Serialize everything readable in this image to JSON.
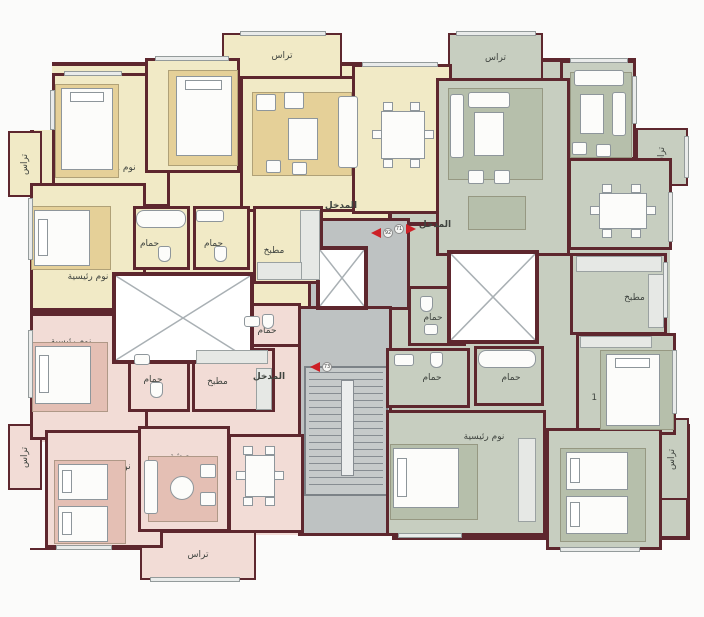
{
  "colors": {
    "wall": "#5e272e",
    "white": "#fbfbfa",
    "label": "#3f443f",
    "red": "#cd2026",
    "u1": "#f1eac6",
    "u2": "#c7cec0",
    "u3": "#f2dcd6",
    "r1": "#e5d098",
    "r2": "#b6bfab",
    "r3": "#e4bfb4",
    "cor": "#bec2c2",
    "stairs": "#c6caca",
    "furn": "#fcfcfa",
    "stroke": "#8e969b",
    "win": "#e9ebea",
    "counter": "#e6e8e5"
  },
  "units_bg": [
    {
      "n": "unit-yellow-bg",
      "x": 30,
      "y": 62,
      "w": 300,
      "h": 250,
      "f": "u1"
    },
    {
      "n": "unit-yellow-east-bg",
      "x": 300,
      "y": 62,
      "w": 152,
      "h": 176,
      "f": "u1"
    },
    {
      "n": "unit-green-north-bg",
      "x": 388,
      "y": 58,
      "w": 282,
      "h": 254,
      "f": "u2"
    },
    {
      "n": "unit-green-bg",
      "x": 388,
      "y": 222,
      "w": 302,
      "h": 318,
      "f": "u2"
    },
    {
      "n": "unit-pink-bg",
      "x": 30,
      "y": 310,
      "w": 300,
      "h": 240,
      "f": "u3"
    }
  ],
  "notches": [
    {
      "x": 30,
      "y": 62,
      "w": 22,
      "h": 68
    },
    {
      "x": 636,
      "y": 58,
      "w": 36,
      "h": 70
    },
    {
      "x": 670,
      "y": 186,
      "w": 22,
      "h": 238
    },
    {
      "x": 304,
      "y": 536,
      "w": 88,
      "h": 46
    },
    {
      "x": 232,
      "y": 535,
      "w": 72,
      "h": 28
    },
    {
      "x": 30,
      "y": 442,
      "w": 15,
      "h": 106
    },
    {
      "x": 388,
      "y": 58,
      "w": 62,
      "h": 8
    }
  ],
  "corridors": [
    {
      "n": "entry-corridor",
      "x": 308,
      "y": 218,
      "w": 102,
      "h": 92
    },
    {
      "n": "stair-hall",
      "x": 298,
      "y": 306,
      "w": 94,
      "h": 230
    }
  ],
  "stairs": {
    "x": 304,
    "y": 366,
    "w": 84,
    "h": 130
  },
  "cores": [
    {
      "n": "light-well",
      "x": 112,
      "y": 272,
      "w": 142,
      "h": 92
    },
    {
      "n": "elevator-left",
      "x": 316,
      "y": 246,
      "w": 52,
      "h": 64
    },
    {
      "n": "elevator-right",
      "x": 447,
      "y": 250,
      "w": 92,
      "h": 94
    }
  ],
  "rooms": [
    {
      "n": "terrace-top-yellow",
      "x": 222,
      "y": 33,
      "w": 120,
      "h": 47,
      "f": "u1",
      "label": "تراس",
      "thin": 1
    },
    {
      "n": "terrace-left-yellow",
      "x": 8,
      "y": 131,
      "w": 34,
      "h": 66,
      "f": "u1",
      "label": "تراس",
      "thin": 1,
      "vert": 1
    },
    {
      "n": "terrace-top-green",
      "x": 448,
      "y": 33,
      "w": 95,
      "h": 50,
      "f": "u2",
      "label": "تراس",
      "thin": 1
    },
    {
      "n": "terrace-corner-green",
      "x": 636,
      "y": 128,
      "w": 52,
      "h": 58,
      "f": "u2",
      "label": "تراس",
      "thin": 1,
      "vert": 1
    },
    {
      "n": "terrace-right-green",
      "x": 655,
      "y": 418,
      "w": 34,
      "h": 82,
      "f": "u2",
      "label": "تراس",
      "thin": 1,
      "vert": 1
    },
    {
      "n": "terrace-left-pink",
      "x": 8,
      "y": 424,
      "w": 34,
      "h": 66,
      "f": "u3",
      "label": "تراس",
      "thin": 1,
      "vert": 1
    },
    {
      "n": "terrace-bottom-pink",
      "x": 140,
      "y": 531,
      "w": 116,
      "h": 49,
      "f": "u3",
      "label": "تراس",
      "thin": 1
    },
    {
      "n": "bedroom-1-yellow",
      "x": 52,
      "y": 73,
      "w": 118,
      "h": 134,
      "f": "u1",
      "label": "نوم 1",
      "dx": 14,
      "dy": 28
    },
    {
      "n": "bedroom-2-yellow",
      "x": 145,
      "y": 58,
      "w": 95,
      "h": 115,
      "f": "u1",
      "label": "نوم 2",
      "dx": 18,
      "dy": -2
    },
    {
      "n": "living-yellow",
      "x": 240,
      "y": 76,
      "w": 122,
      "h": 136,
      "f": "u1",
      "label": "معيشة",
      "dx": 22,
      "dy": -10
    },
    {
      "n": "dining-yellow",
      "x": 352,
      "y": 64,
      "w": 100,
      "h": 150,
      "f": "u1",
      "label": "طعام"
    },
    {
      "n": "master-bedroom-yellow",
      "x": 30,
      "y": 183,
      "w": 116,
      "h": 128,
      "f": "u1",
      "label": "نوم رئيسية",
      "dy": 30
    },
    {
      "n": "bath-1-yellow",
      "x": 133,
      "y": 206,
      "w": 57,
      "h": 64,
      "f": "u1",
      "label": "حمام",
      "dx": -12,
      "dy": 6
    },
    {
      "n": "bath-2-yellow",
      "x": 193,
      "y": 206,
      "w": 57,
      "h": 64,
      "f": "u1",
      "label": "حمام",
      "dx": -8,
      "dy": 6
    },
    {
      "n": "kitchen-yellow",
      "x": 253,
      "y": 206,
      "w": 70,
      "h": 78,
      "f": "u1",
      "label": "مطبخ",
      "dx": -14,
      "dy": 6
    },
    {
      "n": "salon-green",
      "x": 560,
      "y": 60,
      "w": 76,
      "h": 100,
      "f": "u2",
      "label": ""
    },
    {
      "n": "living-green",
      "x": 436,
      "y": 78,
      "w": 134,
      "h": 178,
      "f": "u2",
      "label": "معيشة",
      "dx": 4,
      "dy": -22
    },
    {
      "n": "dining-green",
      "x": 568,
      "y": 158,
      "w": 104,
      "h": 92,
      "f": "u2",
      "label": "طعام",
      "dx": 8,
      "dy": 4
    },
    {
      "n": "kitchen-green",
      "x": 570,
      "y": 253,
      "w": 97,
      "h": 82,
      "f": "u2",
      "label": "مطبخ",
      "dx": 16,
      "dy": 4
    },
    {
      "n": "wc-green",
      "x": 408,
      "y": 286,
      "w": 58,
      "h": 60,
      "f": "u2",
      "label": "حمام",
      "dx": -4,
      "dy": 2
    },
    {
      "n": "bath-1-green",
      "x": 386,
      "y": 348,
      "w": 84,
      "h": 60,
      "f": "u2",
      "label": "حمام",
      "dx": 4
    },
    {
      "n": "bath-2-green",
      "x": 474,
      "y": 346,
      "w": 70,
      "h": 60,
      "f": "u2",
      "label": "حمام",
      "dx": 2,
      "dy": 2
    },
    {
      "n": "bedroom-1-green",
      "x": 576,
      "y": 333,
      "w": 100,
      "h": 102,
      "f": "u2",
      "label": "نوم 1",
      "dx": -24,
      "dy": 14
    },
    {
      "n": "master-bedroom-green",
      "x": 386,
      "y": 410,
      "w": 160,
      "h": 126,
      "f": "u2",
      "label": "نوم رئيسية",
      "dx": 18,
      "dy": -36
    },
    {
      "n": "bedroom-2-green",
      "x": 546,
      "y": 428,
      "w": 116,
      "h": 122,
      "f": "u2",
      "label": "نوم 2",
      "dx": -34,
      "dy": -14
    },
    {
      "n": "master-bedroom-pink",
      "x": 30,
      "y": 313,
      "w": 118,
      "h": 127,
      "f": "u3",
      "label": "نوم رئيسية",
      "dx": -18,
      "dy": -34
    },
    {
      "n": "bath-1-pink",
      "x": 128,
      "y": 348,
      "w": 62,
      "h": 64,
      "f": "u3",
      "label": "حمام",
      "dx": -6
    },
    {
      "n": "kitchen-pink",
      "x": 192,
      "y": 348,
      "w": 83,
      "h": 64,
      "f": "u3",
      "label": "مطبخ",
      "dx": -16,
      "dy": 2
    },
    {
      "n": "bath-2-pink",
      "x": 237,
      "y": 303,
      "w": 64,
      "h": 44,
      "f": "u3",
      "label": "حمام",
      "dx": -2,
      "dy": 6
    },
    {
      "n": "bedroom-1-pink",
      "x": 45,
      "y": 430,
      "w": 118,
      "h": 118,
      "f": "u3",
      "label": "نوم 1",
      "dx": 16,
      "dy": -22
    },
    {
      "n": "living-pink",
      "x": 138,
      "y": 426,
      "w": 92,
      "h": 106,
      "f": "u3",
      "label": "معيشة",
      "dx": -2,
      "dy": -22
    },
    {
      "n": "dining-pink",
      "x": 228,
      "y": 434,
      "w": 76,
      "h": 99,
      "f": "u3",
      "label": "طعام",
      "dy": -12
    }
  ],
  "entrance_labels": [
    {
      "x": 318,
      "y": 202,
      "t": "المدخل"
    },
    {
      "x": 412,
      "y": 221,
      "t": "المدخل"
    },
    {
      "x": 246,
      "y": 373,
      "t": "المدخل"
    }
  ],
  "arrows": [
    {
      "x": 371,
      "y": 228,
      "d": "l",
      "num": "92"
    },
    {
      "x": 406,
      "y": 224,
      "d": "r",
      "num": "71"
    },
    {
      "x": 310,
      "y": 362,
      "d": "l",
      "num": "73"
    }
  ],
  "furniture": [
    {
      "t": "rug",
      "x": 55,
      "y": 84,
      "w": 64,
      "h": 94,
      "f": "r1"
    },
    {
      "t": "bed",
      "x": 61,
      "y": 88,
      "w": 52,
      "h": 82,
      "o": "t"
    },
    {
      "t": "rug",
      "x": 168,
      "y": 70,
      "w": 70,
      "h": 96,
      "f": "r1"
    },
    {
      "t": "bed",
      "x": 176,
      "y": 76,
      "w": 56,
      "h": 80,
      "o": "t"
    },
    {
      "t": "rug",
      "x": 252,
      "y": 92,
      "w": 100,
      "h": 84,
      "f": "r1"
    },
    {
      "t": "sofa",
      "x": 338,
      "y": 96,
      "w": 20,
      "h": 72
    },
    {
      "t": "seat",
      "x": 256,
      "y": 94,
      "w": 20,
      "h": 17
    },
    {
      "t": "seat",
      "x": 284,
      "y": 92,
      "w": 20,
      "h": 17
    },
    {
      "t": "box",
      "x": 288,
      "y": 118,
      "w": 30,
      "h": 42
    },
    {
      "t": "seat",
      "x": 266,
      "y": 160,
      "w": 15,
      "h": 13
    },
    {
      "t": "seat",
      "x": 292,
      "y": 162,
      "w": 15,
      "h": 13
    },
    {
      "t": "dining",
      "x": 372,
      "y": 102,
      "w": 62,
      "h": 66
    },
    {
      "t": "rug",
      "x": 31,
      "y": 206,
      "w": 80,
      "h": 64,
      "f": "r1"
    },
    {
      "t": "bed",
      "x": 34,
      "y": 210,
      "w": 56,
      "h": 56,
      "o": "l"
    },
    {
      "t": "tub",
      "x": 136,
      "y": 210,
      "w": 50,
      "h": 18
    },
    {
      "t": "wc",
      "x": 158,
      "y": 246,
      "w": 13,
      "h": 16
    },
    {
      "t": "sink",
      "x": 196,
      "y": 210,
      "w": 28,
      "h": 12
    },
    {
      "t": "wc",
      "x": 214,
      "y": 246,
      "w": 13,
      "h": 16
    },
    {
      "t": "counter",
      "x": 300,
      "y": 210,
      "w": 20,
      "h": 70
    },
    {
      "t": "counter",
      "x": 257,
      "y": 262,
      "w": 45,
      "h": 18
    },
    {
      "t": "rug",
      "x": 448,
      "y": 88,
      "w": 95,
      "h": 92,
      "f": "r2"
    },
    {
      "t": "sofa",
      "x": 468,
      "y": 92,
      "w": 42,
      "h": 16
    },
    {
      "t": "sofa",
      "x": 450,
      "y": 94,
      "w": 14,
      "h": 64
    },
    {
      "t": "box",
      "x": 474,
      "y": 112,
      "w": 30,
      "h": 44
    },
    {
      "t": "seat",
      "x": 468,
      "y": 170,
      "w": 16,
      "h": 14
    },
    {
      "t": "seat",
      "x": 494,
      "y": 170,
      "w": 16,
      "h": 14
    },
    {
      "t": "rug",
      "x": 468,
      "y": 196,
      "w": 58,
      "h": 34,
      "f": "r2"
    },
    {
      "t": "rug",
      "x": 570,
      "y": 72,
      "w": 62,
      "h": 86,
      "f": "r2"
    },
    {
      "t": "sofa",
      "x": 574,
      "y": 70,
      "w": 50,
      "h": 16
    },
    {
      "t": "box",
      "x": 580,
      "y": 94,
      "w": 24,
      "h": 40
    },
    {
      "t": "sofa",
      "x": 612,
      "y": 92,
      "w": 14,
      "h": 44
    },
    {
      "t": "seat",
      "x": 572,
      "y": 142,
      "w": 15,
      "h": 13
    },
    {
      "t": "seat",
      "x": 596,
      "y": 144,
      "w": 15,
      "h": 13
    },
    {
      "t": "dining",
      "x": 590,
      "y": 184,
      "w": 66,
      "h": 54
    },
    {
      "t": "counter",
      "x": 576,
      "y": 256,
      "w": 86,
      "h": 16
    },
    {
      "t": "counter",
      "x": 648,
      "y": 274,
      "w": 16,
      "h": 54
    },
    {
      "t": "wc",
      "x": 420,
      "y": 296,
      "w": 13,
      "h": 16
    },
    {
      "t": "sink",
      "x": 424,
      "y": 324,
      "w": 14,
      "h": 11
    },
    {
      "t": "sink",
      "x": 394,
      "y": 354,
      "w": 20,
      "h": 12
    },
    {
      "t": "wc",
      "x": 430,
      "y": 352,
      "w": 13,
      "h": 16
    },
    {
      "t": "tub",
      "x": 478,
      "y": 350,
      "w": 58,
      "h": 18
    },
    {
      "t": "counter",
      "x": 580,
      "y": 336,
      "w": 72,
      "h": 12
    },
    {
      "t": "rug",
      "x": 600,
      "y": 350,
      "w": 74,
      "h": 80,
      "f": "r2"
    },
    {
      "t": "bed",
      "x": 606,
      "y": 354,
      "w": 54,
      "h": 72,
      "o": "t"
    },
    {
      "t": "rug",
      "x": 390,
      "y": 444,
      "w": 88,
      "h": 76,
      "f": "r2"
    },
    {
      "t": "bed",
      "x": 393,
      "y": 448,
      "w": 66,
      "h": 60,
      "o": "l"
    },
    {
      "t": "counter",
      "x": 518,
      "y": 438,
      "w": 18,
      "h": 84
    },
    {
      "t": "rug",
      "x": 560,
      "y": 448,
      "w": 86,
      "h": 94,
      "f": "r2"
    },
    {
      "t": "bed",
      "x": 566,
      "y": 452,
      "w": 62,
      "h": 38,
      "o": "l"
    },
    {
      "t": "bed",
      "x": 566,
      "y": 496,
      "w": 62,
      "h": 38,
      "o": "l"
    },
    {
      "t": "rug",
      "x": 32,
      "y": 342,
      "w": 76,
      "h": 70,
      "f": "r3"
    },
    {
      "t": "bed",
      "x": 35,
      "y": 346,
      "w": 56,
      "h": 58,
      "o": "l"
    },
    {
      "t": "sink",
      "x": 134,
      "y": 354,
      "w": 16,
      "h": 11
    },
    {
      "t": "wc",
      "x": 150,
      "y": 382,
      "w": 13,
      "h": 16
    },
    {
      "t": "counter",
      "x": 196,
      "y": 350,
      "w": 72,
      "h": 14
    },
    {
      "t": "counter",
      "x": 256,
      "y": 368,
      "w": 16,
      "h": 42
    },
    {
      "t": "wc",
      "x": 262,
      "y": 314,
      "w": 12,
      "h": 15
    },
    {
      "t": "sink",
      "x": 244,
      "y": 316,
      "w": 16,
      "h": 11
    },
    {
      "t": "rug",
      "x": 54,
      "y": 460,
      "w": 72,
      "h": 84,
      "f": "r3"
    },
    {
      "t": "bed",
      "x": 58,
      "y": 464,
      "w": 50,
      "h": 36,
      "o": "l"
    },
    {
      "t": "bed",
      "x": 58,
      "y": 506,
      "w": 50,
      "h": 36,
      "o": "l"
    },
    {
      "t": "rug",
      "x": 148,
      "y": 456,
      "w": 70,
      "h": 66,
      "f": "r3"
    },
    {
      "t": "sofa",
      "x": 144,
      "y": 460,
      "w": 14,
      "h": 54
    },
    {
      "t": "round",
      "x": 170,
      "y": 476,
      "w": 24,
      "h": 24
    },
    {
      "t": "seat",
      "x": 200,
      "y": 464,
      "w": 16,
      "h": 14
    },
    {
      "t": "seat",
      "x": 200,
      "y": 492,
      "w": 16,
      "h": 14
    },
    {
      "t": "dining",
      "x": 236,
      "y": 446,
      "w": 48,
      "h": 60
    }
  ],
  "windows": [
    {
      "x": 64,
      "y": 71,
      "w": 58,
      "h": 5
    },
    {
      "x": 155,
      "y": 56,
      "w": 74,
      "h": 5
    },
    {
      "x": 240,
      "y": 31,
      "w": 86,
      "h": 5
    },
    {
      "x": 362,
      "y": 62,
      "w": 76,
      "h": 5
    },
    {
      "x": 456,
      "y": 31,
      "w": 80,
      "h": 5
    },
    {
      "x": 570,
      "y": 58,
      "w": 58,
      "h": 5
    },
    {
      "x": 632,
      "y": 76,
      "w": 5,
      "h": 48
    },
    {
      "x": 684,
      "y": 136,
      "w": 5,
      "h": 42
    },
    {
      "x": 668,
      "y": 192,
      "w": 5,
      "h": 50
    },
    {
      "x": 663,
      "y": 262,
      "w": 5,
      "h": 56
    },
    {
      "x": 672,
      "y": 350,
      "w": 5,
      "h": 64
    },
    {
      "x": 398,
      "y": 533,
      "w": 64,
      "h": 5
    },
    {
      "x": 560,
      "y": 547,
      "w": 80,
      "h": 5
    },
    {
      "x": 28,
      "y": 198,
      "w": 5,
      "h": 62
    },
    {
      "x": 28,
      "y": 330,
      "w": 5,
      "h": 68
    },
    {
      "x": 56,
      "y": 545,
      "w": 56,
      "h": 5
    },
    {
      "x": 150,
      "y": 577,
      "w": 90,
      "h": 5
    },
    {
      "x": 50,
      "y": 90,
      "w": 5,
      "h": 40
    }
  ]
}
